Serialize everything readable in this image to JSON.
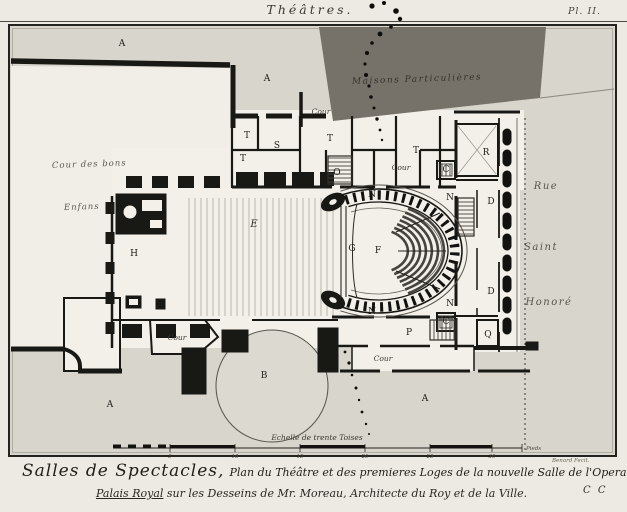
{
  "plate": {
    "header_title": "Théâtres.",
    "plate_number": "Pl. II.",
    "engraver": "Benard Fecit.",
    "signature_mark": "C C"
  },
  "caption": {
    "lead": "Salles de Spectacles,",
    "line1_rest": "Plan du Théâtre et des premieres Loges de la nouvelle Salle de l'Opera exécutée au",
    "line2_a": "Palais Royal",
    "line2_b": " sur les Desseins de Mr. Moreau, Architecte du Roy et de la Ville."
  },
  "scale_bar": {
    "label": "Echelle de trente Toises",
    "end_label": "Pieds",
    "ticks": [
      {
        "t": "5",
        "x": 170
      },
      {
        "t": "10",
        "x": 235
      },
      {
        "t": "15",
        "x": 300
      },
      {
        "t": "20",
        "x": 365
      },
      {
        "t": "25",
        "x": 430
      },
      {
        "t": "30",
        "x": 492
      }
    ]
  },
  "plan": {
    "dark_block_label": "Maisons Particulières",
    "labels": [
      {
        "t": "Maisons Particulières",
        "x": 352,
        "y": 84,
        "kind": "area",
        "rot": -2
      },
      {
        "t": "Cour des bons",
        "x": 52,
        "y": 168,
        "kind": "hand",
        "rot": -2
      },
      {
        "t": "Enfans",
        "x": 64,
        "y": 210,
        "kind": "hand",
        "rot": -2
      },
      {
        "t": "Rue",
        "x": 546,
        "y": 189,
        "kind": "street"
      },
      {
        "t": "Saint",
        "x": 541,
        "y": 250,
        "kind": "street"
      },
      {
        "t": "Honoré",
        "x": 549,
        "y": 305,
        "kind": "street"
      },
      {
        "t": "Cour",
        "x": 321,
        "y": 114,
        "kind": "cour"
      },
      {
        "t": "Cour",
        "x": 401,
        "y": 170,
        "kind": "cour"
      },
      {
        "t": "Cour",
        "x": 177,
        "y": 340,
        "kind": "cour"
      },
      {
        "t": "Cour",
        "x": 383,
        "y": 361,
        "kind": "cour"
      },
      {
        "t": "A",
        "x": 122,
        "y": 46,
        "kind": "letter"
      },
      {
        "t": "A",
        "x": 267,
        "y": 81,
        "kind": "letter"
      },
      {
        "t": "A",
        "x": 110,
        "y": 407,
        "kind": "letter"
      },
      {
        "t": "A",
        "x": 425,
        "y": 401,
        "kind": "letter"
      },
      {
        "t": "B",
        "x": 264,
        "y": 378,
        "kind": "letter"
      },
      {
        "t": "C",
        "x": 446,
        "y": 172,
        "kind": "letter"
      },
      {
        "t": "C",
        "x": 446,
        "y": 324,
        "kind": "letter"
      },
      {
        "t": "D",
        "x": 491,
        "y": 204,
        "kind": "letter"
      },
      {
        "t": "D",
        "x": 491,
        "y": 294,
        "kind": "letter"
      },
      {
        "t": "E",
        "x": 254,
        "y": 227,
        "kind": "script"
      },
      {
        "t": "F",
        "x": 378,
        "y": 253,
        "kind": "letter"
      },
      {
        "t": "G",
        "x": 352,
        "y": 251,
        "kind": "letter"
      },
      {
        "t": "H",
        "x": 134,
        "y": 256,
        "kind": "letter"
      },
      {
        "t": "N",
        "x": 372,
        "y": 197,
        "kind": "letter"
      },
      {
        "t": "N",
        "x": 450,
        "y": 200,
        "kind": "letter"
      },
      {
        "t": "N",
        "x": 372,
        "y": 314,
        "kind": "letter"
      },
      {
        "t": "N",
        "x": 450,
        "y": 306,
        "kind": "letter"
      },
      {
        "t": "O",
        "x": 337,
        "y": 175,
        "kind": "letter"
      },
      {
        "t": "P",
        "x": 409,
        "y": 335,
        "kind": "letter"
      },
      {
        "t": "Q",
        "x": 488,
        "y": 337,
        "kind": "letter"
      },
      {
        "t": "R",
        "x": 486,
        "y": 155,
        "kind": "letter"
      },
      {
        "t": "S",
        "x": 277,
        "y": 148,
        "kind": "letter"
      },
      {
        "t": "T",
        "x": 247,
        "y": 138,
        "kind": "letter"
      },
      {
        "t": "T",
        "x": 330,
        "y": 141,
        "kind": "letter"
      },
      {
        "t": "T",
        "x": 416,
        "y": 153,
        "kind": "letter"
      },
      {
        "t": "T",
        "x": 243,
        "y": 161,
        "kind": "letter"
      }
    ],
    "ink_dots": [
      {
        "x": 372,
        "y": 6,
        "r": 2.6
      },
      {
        "x": 384,
        "y": 3,
        "r": 2
      },
      {
        "x": 396,
        "y": 11,
        "r": 2.8
      },
      {
        "x": 400,
        "y": 19,
        "r": 2.2
      },
      {
        "x": 391,
        "y": 27,
        "r": 1.8
      },
      {
        "x": 380,
        "y": 34,
        "r": 2.4
      },
      {
        "x": 372,
        "y": 43,
        "r": 1.8
      },
      {
        "x": 367,
        "y": 53,
        "r": 2
      },
      {
        "x": 365,
        "y": 64,
        "r": 1.6
      },
      {
        "x": 366,
        "y": 75,
        "r": 2
      },
      {
        "x": 369,
        "y": 86,
        "r": 1.6
      },
      {
        "x": 371,
        "y": 97,
        "r": 1.8
      },
      {
        "x": 374,
        "y": 108,
        "r": 1.5
      },
      {
        "x": 377,
        "y": 119,
        "r": 1.7
      },
      {
        "x": 380,
        "y": 130,
        "r": 1.4
      },
      {
        "x": 382,
        "y": 140,
        "r": 1.2
      },
      {
        "x": 345,
        "y": 352,
        "r": 1.4
      },
      {
        "x": 349,
        "y": 363,
        "r": 1.6
      },
      {
        "x": 352,
        "y": 375,
        "r": 1.3
      },
      {
        "x": 356,
        "y": 388,
        "r": 1.5
      },
      {
        "x": 359,
        "y": 400,
        "r": 1.2
      },
      {
        "x": 362,
        "y": 412,
        "r": 1.4
      },
      {
        "x": 366,
        "y": 424,
        "r": 1.2
      },
      {
        "x": 369,
        "y": 434,
        "r": 1
      }
    ]
  },
  "colors": {
    "paper": "#eceae2",
    "wash": "#d8d5cc",
    "building_white": "#f2f0e8",
    "dark_block": "#76726a",
    "ink": "#181814"
  }
}
